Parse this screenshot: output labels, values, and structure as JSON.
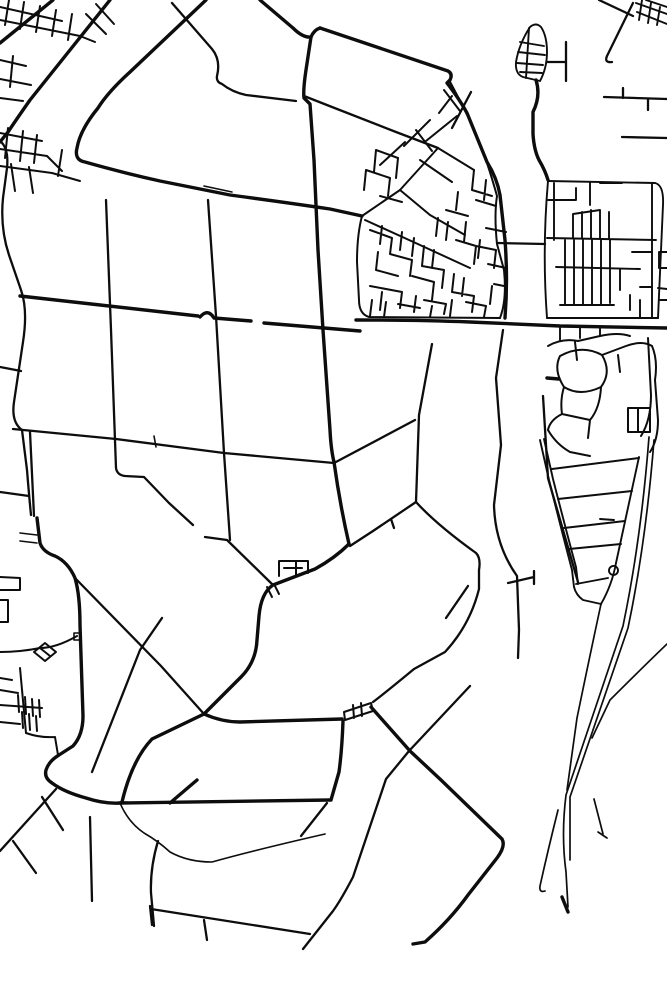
{
  "map": {
    "kind": "minimalist-road-network-map",
    "background_color": "#ffffff",
    "stroke_color": "#0d0d0d",
    "canvas": {
      "width": 667,
      "height": 1000
    },
    "layers": [
      {
        "name": "major-roads",
        "width": 3.4,
        "paths": [
          "M53,0 L0,43",
          "M110,0 L30,100 Q16,120 8,132 L0,142",
          "M206,0 L130,72 Q108,92 98,108 Q80,130 77,148 Q74,160 85,162 Q120,172 160,181 L230,195 Q290,203 330,209 L362,216",
          "M356,320 Q420,320 470,322 L560,326 L667,328",
          "M37,518 L40,543 Q43,552 55,556 Q68,562 75,578 Q80,595 80,625 L83,716 Q83,735 73,746 L59,755 Q49,761 46,770 Q44,778 52,783 Q64,792 86,798 Q104,804 120,803",
          "M120,803 L330,800",
          "M170,803 L197,780",
          "M320,28 L448,71 Q453,74 450,80 L447,83 Q460,100 467,113 L487,162 Q497,178 500,195 L505,240 Q508,280 505,318",
          "M260,0 L293,28 Q303,38 311,37 Q314,30 320,28",
          "M311,37 L306,70 Q303,90 304,98 L310,104 L314,160 L318,250 L323,330 L330,430 Q331,450 334,462",
          "M334,462 Q340,505 349,544",
          "M349,544 Q335,558 315,569 L273,585 Q261,593 259,616 L257,640 Q256,662 241,677 L204,714",
          "M204,714 Q222,722 240,722 L342,719",
          "M204,714 L152,739 Q132,760 122,802",
          "M343,721 Q342,750 339,772 L331,800",
          "M371,707 L410,751 L441,780 L502,839 Q506,846 497,858 L468,895 Q450,920 425,942 L413,944",
          "M547,378 L559,379",
          "M536,80 Q541,96 533,112 L533,134 Q534,150 539,160 Q545,170 548,180",
          "M20,296 L198,316",
          "M200,317 Q208,308 214,318 L251,321",
          "M264,323 L360,331",
          "M562,897 L568,912"
        ]
      },
      {
        "name": "secondary-roads",
        "width": 2.3,
        "paths": [
          "M172,3 L212,49 Q221,60 217,76 Q216,82 222,84 Q232,92 246,95 L296,101",
          "M304,96 L332,107 L396,132 L438,148",
          "M106,200 L111,330 L116,468 Q117,475 125,476 L144,477 L169,503 L193,525",
          "M205,537 L227,540 L273,585",
          "M208,200 L216,316 L224,453 L230,540",
          "M13,429 L116,439 L224,453 L334,463 L415,420",
          "M0,141 Q9,148 7,168 L3,198 Q0,228 9,255 L21,290 Q28,310 23,342 L14,402 Q11,422 22,430 L27,470 Q29,495 31,515",
          "M0,367 L21,371",
          "M0,492 L29,496",
          "M30,432 L34,516",
          "M503,330 L496,378 L501,445 L494,505 Q495,545 517,576 L519,630 L518,658",
          "M508,583 L534,577 M534,571 L534,584",
          "M432,344 L419,415 L416,502 Q437,525 476,553 Q481,558 479,570 L479,589 Q470,625 445,652 L414,669 Q385,693 373,702",
          "M416,502 L373,531 L350,546",
          "M391,519 L394,528",
          "M446,618 L468,586",
          "M75,578 L161,666 L204,714",
          "M162,618 L140,650 L92,772",
          "M470,686 L409,751 L386,779 L353,877 Q341,900 333,911 L303,949",
          "M151,909 L310,934",
          "M204,920 L207,940",
          "M150,906 L152,925",
          "M158,841 Q150,868 151,893 L154,926",
          "M56,789 L0,851",
          "M42,797 L63,830",
          "M13,841 L36,873",
          "M90,817 L92,901",
          "M543,396 L548,478 L578,582",
          "M498,243 L545,244",
          "M604,97 L667,99 M623,88 L623,98 M648,99 L648,110",
          "M622,137 L667,138",
          "M599,0 L633,16 M633,3 L607,56 Q604,63 612,62",
          "M547,62 L566,62 M566,42 L566,81",
          "M450,82 L470,120 M471,92 L452,128",
          "M327,803 L301,836"
        ]
      },
      {
        "name": "town-streets",
        "width": 2.0,
        "paths": [
          "M362,216 Q357,235 357,262 L359,300 Q359,314 369,317 L500,318",
          "M500,318 Q507,300 504,270 L497,244 Q494,215 497,196 Q492,178 487,163",
          "M362,216 L400,190 L438,148",
          "M438,148 L474,170 M420,160 L452,182 M405,142 L380,165 M430,120 L404,146 M444,90 L460,111 M452,96 L439,113 M457,116 L426,141 M416,130 L432,151",
          "M365,220 L420,245 L470,268",
          "M400,190 L430,215 L465,235",
          "M370,230 L392,238 M392,238 L390,254 M390,254 L412,260 M412,260 L410,276 M378,252 L376,270 M376,270 L398,276 M370,286 L402,292 M402,292 L400,308 M382,292 L380,310 M414,238 L412,256 M424,246 L422,266 M422,266 L444,270 M434,250 L432,268 M444,270 L442,288 M412,276 L434,282 M434,282 L432,300 M416,296 L414,312 M424,300 L446,304 M446,304 L444,314 M454,274 L452,292 M452,292 L474,296 M464,278 L462,296 M474,296 L472,312 M456,240 L476,246 M476,246 L474,264 M466,222 L464,242 M476,200 L496,206 M486,180 L484,200 M476,246 L496,250 M496,250 L494,268 M486,228 L506,232 M474,170 L472,190 M472,190 L492,196 M458,192 L456,210 M446,210 L468,216 M438,218 L436,236 M448,222 L446,240 M382,226 L380,244 M402,232 L400,250",
          "M366,170 L390,178 M366,170 L364,190 M376,150 L398,158 M376,150 L374,172 M390,178 L388,196 M398,158 L396,178 M380,196 L402,202",
          "M372,300 L370,316 M386,302 L384,317 M398,304 L420,308 M432,306 L430,317 M452,300 L450,316 M466,302 L486,306 M486,306 L484,317 M492,286 L490,304",
          "M488,264 L506,268 M494,284 L504,286 M480,240 L478,258",
          "M548,346 Q562,338 578,341 L600,336 Q618,332 630,336",
          "M560,356 Q582,344 602,355 Q612,372 601,387 Q580,397 564,387 Q553,370 560,356",
          "M602,355 L626,346 Q642,340 652,346 M648,338 L651,395 Q651,420 641,436 M652,346 Q658,360 655,380",
          "M628,408 L650,408 L650,432 L628,432 Z M638,408 L638,432",
          "M564,387 Q560,400 562,414 M562,414 L590,420 M590,420 Q600,408 601,387 M575,342 L577,360 M618,355 L620,372 M590,420 L588,438 M562,414 Q550,420 548,430",
          "M655,380 L658,420 Q658,440 650,452",
          "M548,430 Q556,444 570,452 L590,456",
          "M279,576 L279,561 L296,561 L296,575 M296,561 L308,561 L308,573 M284,568 L302,568 M267,587 L272,597 M274,584 L279,594",
          "M344,712 L371,703 L373,711 L345,720 Z M353,705 L354,718 M361,703 L362,716",
          "M0,7 L62,21 M0,20 L80,36 M9,0 L5,25 M24,2 L20,29 M40,6 L36,32 M56,10 L52,36 M72,14 L68,40 M80,36 L95,42",
          "M96,4 L114,24 M86,14 L106,34",
          "M0,60 L26,66 M0,79 L31,85 M13,56 L10,87 M0,98 L23,101",
          "M0,133 L42,141 M0,149 L47,156 M8,128 L5,158 M23,131 L20,161 M37,135 L34,163 M0,166 L52,173 M11,164 L15,191 M29,167 L33,193 M47,156 L62,171 M52,173 L80,181 M62,150 L58,176",
          "M77,636 Q56,648 40,648 Q20,652 0,652",
          "M34,652 L45,643 L56,652 L45,661 Z M40,648 L50,656",
          "M20,668 L26,733",
          "M0,705 L42,708",
          "M18,695 L19,712 M25,697 L26,714 M32,699 L33,716 M39,700 L40,717 M22,712 L23,728 M29,714 L30,730 M36,716 L37,731",
          "M0,690 L18,693 M0,722 L20,724 M26,733 Q40,738 55,737 M55,737 L58,755 M0,678 L12,680",
          "M0,577 L20,578 L20,590 L0,590 M0,600 L8,600 L8,622 L0,622"
        ]
      },
      {
        "name": "grid-and-detail",
        "width": 1.9,
        "paths": [
          "M548,181 L655,183 Q664,185 663,205 L658,318",
          "M548,181 Q542,250 547,318",
          "M547,318 L658,318",
          "M554,183 L554,240",
          "M548,200 L576,200 M576,188 L576,200 M590,183 L590,205 M600,183 L622,183",
          "M547,238 L656,240",
          "M573,214 L573,238 M582,212 L582,238 M591,210 L591,238 M600,210 L600,238 M609,212 L609,238 M573,214 L600,210",
          "M556,267 L640,269",
          "M565,240 L565,305 M574,240 L574,305 M583,240 L583,305 M592,240 L592,305 M601,240 L601,305 M610,240 L610,303 M560,305 L614,305",
          "M652,183 L652,318",
          "M632,252 L652,252 M640,287 L652,287 M620,269 L620,290 M630,295 L630,310 M640,300 L640,318",
          "M659,252 L667,252 M659,252 L659,268 M659,268 L667,268 M658,288 L667,289 M660,300 L667,300",
          "M560,328 L560,340 M580,327 L580,338 M600,327 L600,336",
          "M530,27 Q519,44 516,62 Q515,74 523,77 L540,81 Q547,68 547,52 Q547,36 541,27 Q536,22 530,27",
          "M520,42 L544,46 M518,52 L545,55 M517,63 L543,65 M520,72 L542,73 M529,28 L526,78",
          "M636,3 L667,14 M637,12 L667,24 M642,0 L639,20 M651,3 L648,23 M660,7 L657,25 M646,0 L667,7",
          "M540,440 L549,480 Q562,532 572,570 L574,587 Q576,595 583,600 L601,604",
          "M544,439 L553,479 Q566,530 576,567 L578,584",
          "M639,457 L616,563 Q612,585 601,604",
          "M552,469 L639,458 M558,499 L632,491 M564,528 L625,521 M569,549 L621,544 M576,584 L608,578 M600,519 L614,520",
          "M609,570 a4.5,4.5 0 1 0 9,1 a4.5,4.5 0 1 0 -9,-1"
        ]
      },
      {
        "name": "motorway-lines",
        "width": 1.7,
        "paths": [
          "M649,437 Q641,540 623,626 L566,795 Q561,835 566,872 L568,907",
          "M654,440 Q646,542 628,628 L570,797 L570,860",
          "M601,604 Q590,655 577,718 L567,790",
          "M667,644 Q642,668 610,700 L592,738",
          "M594,799 L603,834 M598,832 L607,838",
          "M558,810 Q548,850 540,886 Q539,893 545,891"
        ]
      },
      {
        "name": "thin-boundaries",
        "width": 1.6,
        "paths": [
          "M120,803 Q128,822 144,833 Q158,841 170,852 Q188,862 212,862 Q255,850 325,834",
          "M154,436 L156,447",
          "M204,186 L232,192",
          "M20,533 L37,535 M20,541 L37,543",
          "M74,633 L81,633 L81,640 L74,640 Z"
        ]
      }
    ]
  }
}
